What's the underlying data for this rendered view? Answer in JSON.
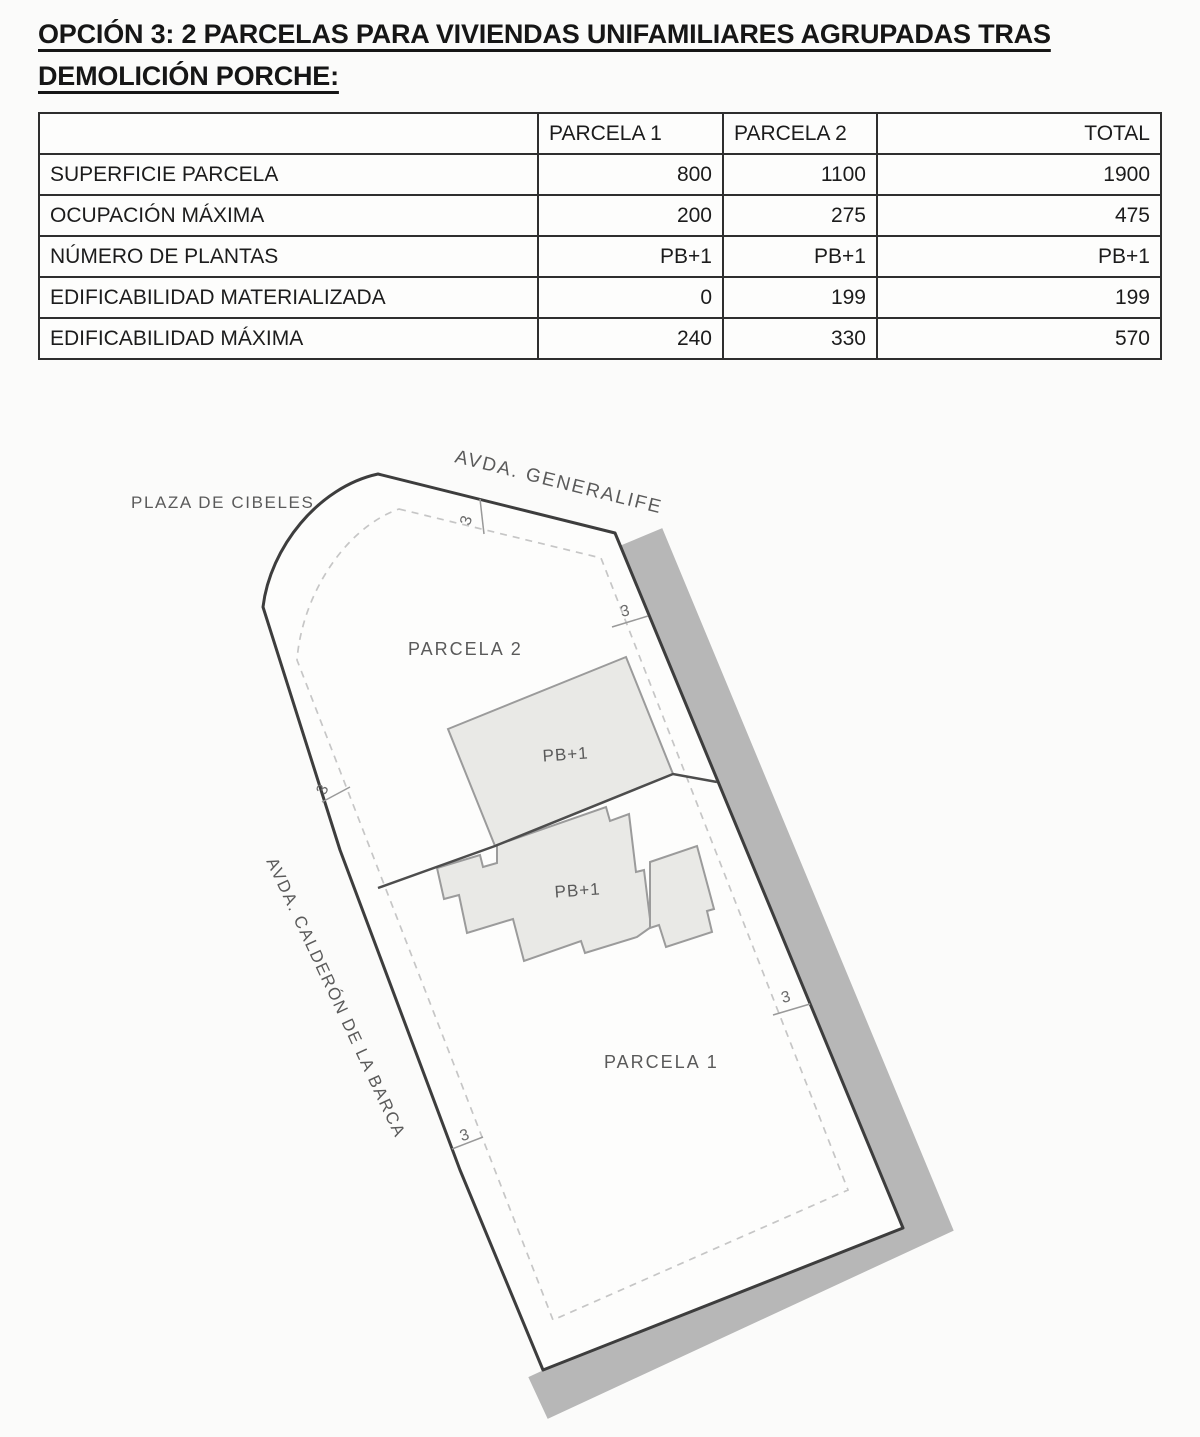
{
  "title": {
    "line1": "OPCIÓN 3: 2 PARCELAS PARA VIVIENDAS UNIFAMILIARES AGRUPADAS TRAS",
    "line2": "DEMOLICIÓN PORCHE:"
  },
  "table": {
    "headers": [
      "",
      "PARCELA 1",
      "PARCELA 2",
      "TOTAL"
    ],
    "rows": [
      [
        "SUPERFICIE PARCELA",
        "800",
        "1100",
        "1900"
      ],
      [
        "OCUPACIÓN MÁXIMA",
        "200",
        "275",
        "475"
      ],
      [
        "NÚMERO DE PLANTAS",
        "PB+1",
        "PB+1",
        "PB+1"
      ],
      [
        "EDIFICABILIDAD MATERIALIZADA",
        "0",
        "199",
        "199"
      ],
      [
        "EDIFICABILIDAD MÁXIMA",
        "240",
        "330",
        "570"
      ]
    ]
  },
  "plan": {
    "streets": {
      "top": "AVDA. GENERALIFE",
      "left_top": "PLAZA DE CIBELES",
      "left": "AVDA. CALDERÓN DE LA BARCA"
    },
    "parcels": {
      "parcel2": "PARCELA 2",
      "parcel1": "PARCELA 1"
    },
    "building_label": "PB+1",
    "setback_label": "3",
    "colors": {
      "street_band": "#b7b7b7",
      "site_fill": "#fdfdfc",
      "boundary": "#3d3d3d",
      "setback_dash": "#c6c6c6",
      "building_fill": "#e9e9e6",
      "building_outline": "#9b9b9b",
      "division_line": "#4d4d4d",
      "label_text": "#5a5a5a",
      "dim_text": "#6a6a6a",
      "tick": "#999999"
    }
  }
}
